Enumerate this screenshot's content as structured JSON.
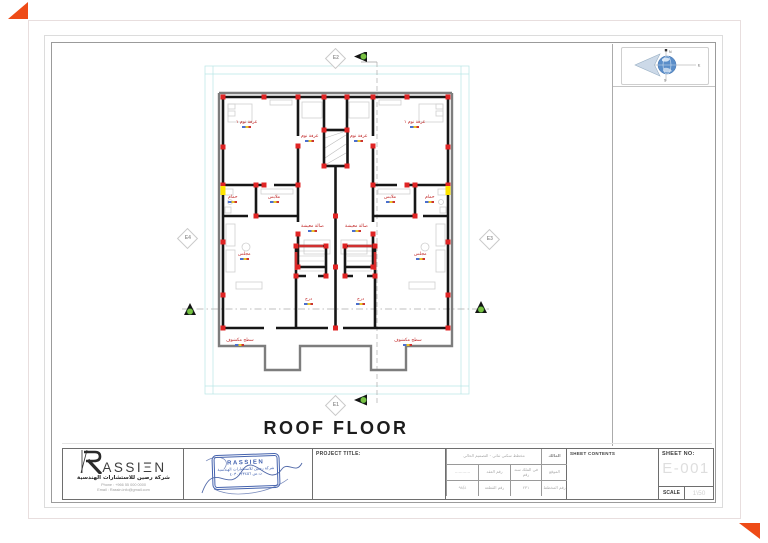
{
  "page": {
    "accent_orange": "#ee4b17",
    "column_red": "#e02424",
    "marker_yellow": "#ffe500",
    "wall_black": "#161616",
    "roof_gray": "#7d7d7d",
    "stamp_blue": "#4563ae"
  },
  "plan_title": "ROOF FLOOR",
  "markers": {
    "e1": "E1",
    "e2": "E2",
    "e3": "E3",
    "e4": "E4"
  },
  "compass": {
    "n": "N",
    "e": "E",
    "s": "S"
  },
  "logo": {
    "text": "RASSIEN",
    "display_letters": "ASSIΞN",
    "subtitle": "شركة رصين للاستشارات الهندسية",
    "phone": "Phone : +966 55 000 0000",
    "email": "Email : Rassin.info@gmail.com"
  },
  "stamp": {
    "brand": "RASSIEN",
    "line1": "شركة رصين للاستشارات الهندسية",
    "line2": "ت.س ٤٠٣٠١٢٣٤٥٦"
  },
  "titleblock": {
    "project_title_label": "PROJECT TITLE:",
    "sheet_contents_label": "SHEET CONTENTS",
    "sheet_no_label": "SHEET NO:",
    "sheet_no_value": "E-001",
    "scale_label": "SCALE",
    "scale_value": "1\\50",
    "table": {
      "header": "مخطط سكني ثنائي - التصميم الحالي",
      "side1": "المالك",
      "side2": "الموقع",
      "side3": "رقم المخطط",
      "r2c1": "............",
      "r2c2": "رقم العقد",
      "r2c3": "في الملك سند رقم",
      "r3c1": "٩٨/٤",
      "r3c2": "رقم القطعة",
      "r3c3": "٢٣١"
    }
  },
  "plan": {
    "labels": [
      {
        "t": "غرفة نوم ١",
        "x": 58,
        "y": 68
      },
      {
        "t": "غرفة نوم ١",
        "x": 226,
        "y": 68
      },
      {
        "t": "غرفة نوم",
        "x": 123,
        "y": 82
      },
      {
        "t": "غرفة نوم",
        "x": 172,
        "y": 82
      },
      {
        "t": "حمام",
        "x": 50,
        "y": 143
      },
      {
        "t": "حمام",
        "x": 247,
        "y": 143
      },
      {
        "t": "ملابس",
        "x": 90,
        "y": 143
      },
      {
        "t": "ملابس",
        "x": 206,
        "y": 143
      },
      {
        "t": "صالة معيشة",
        "x": 123,
        "y": 172
      },
      {
        "t": "صالة معيشة",
        "x": 167,
        "y": 172
      },
      {
        "t": "مجلس",
        "x": 60,
        "y": 200
      },
      {
        "t": "مجلس",
        "x": 236,
        "y": 200
      },
      {
        "t": "درج",
        "x": 126,
        "y": 245
      },
      {
        "t": "درج",
        "x": 178,
        "y": 245
      },
      {
        "t": "سطح مكشوف",
        "x": 48,
        "y": 286
      },
      {
        "t": "سطح مكشوف",
        "x": 216,
        "y": 286
      }
    ]
  }
}
